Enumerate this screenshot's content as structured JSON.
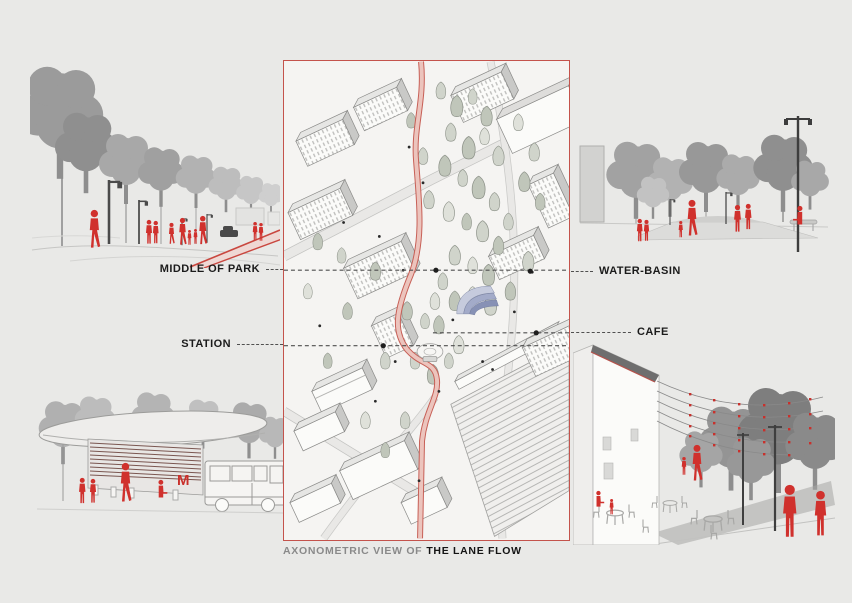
{
  "board": {
    "background": "#e9e9e7",
    "accent_red": "#d0312d",
    "frame_red": "#c4534c"
  },
  "annotations": {
    "middle_of_park": "MIDDLE OF PARK",
    "water_basin": "WATER-BASIN",
    "station": "STATION",
    "cafe": "CAFE"
  },
  "caption": {
    "prefix": "AXONOMETRIC VIEW OF",
    "title": "THE LANE FLOW"
  },
  "metro_logo": "M",
  "icons": {
    "person": "red human silhouette",
    "tree": "gray tree blob",
    "lamp": "street lamp post",
    "string_lights": "catenary wires with red bulbs",
    "metro_m": "red metro M logo",
    "water_basin": "blue terraced basin fan",
    "lane": "red winding lane"
  }
}
